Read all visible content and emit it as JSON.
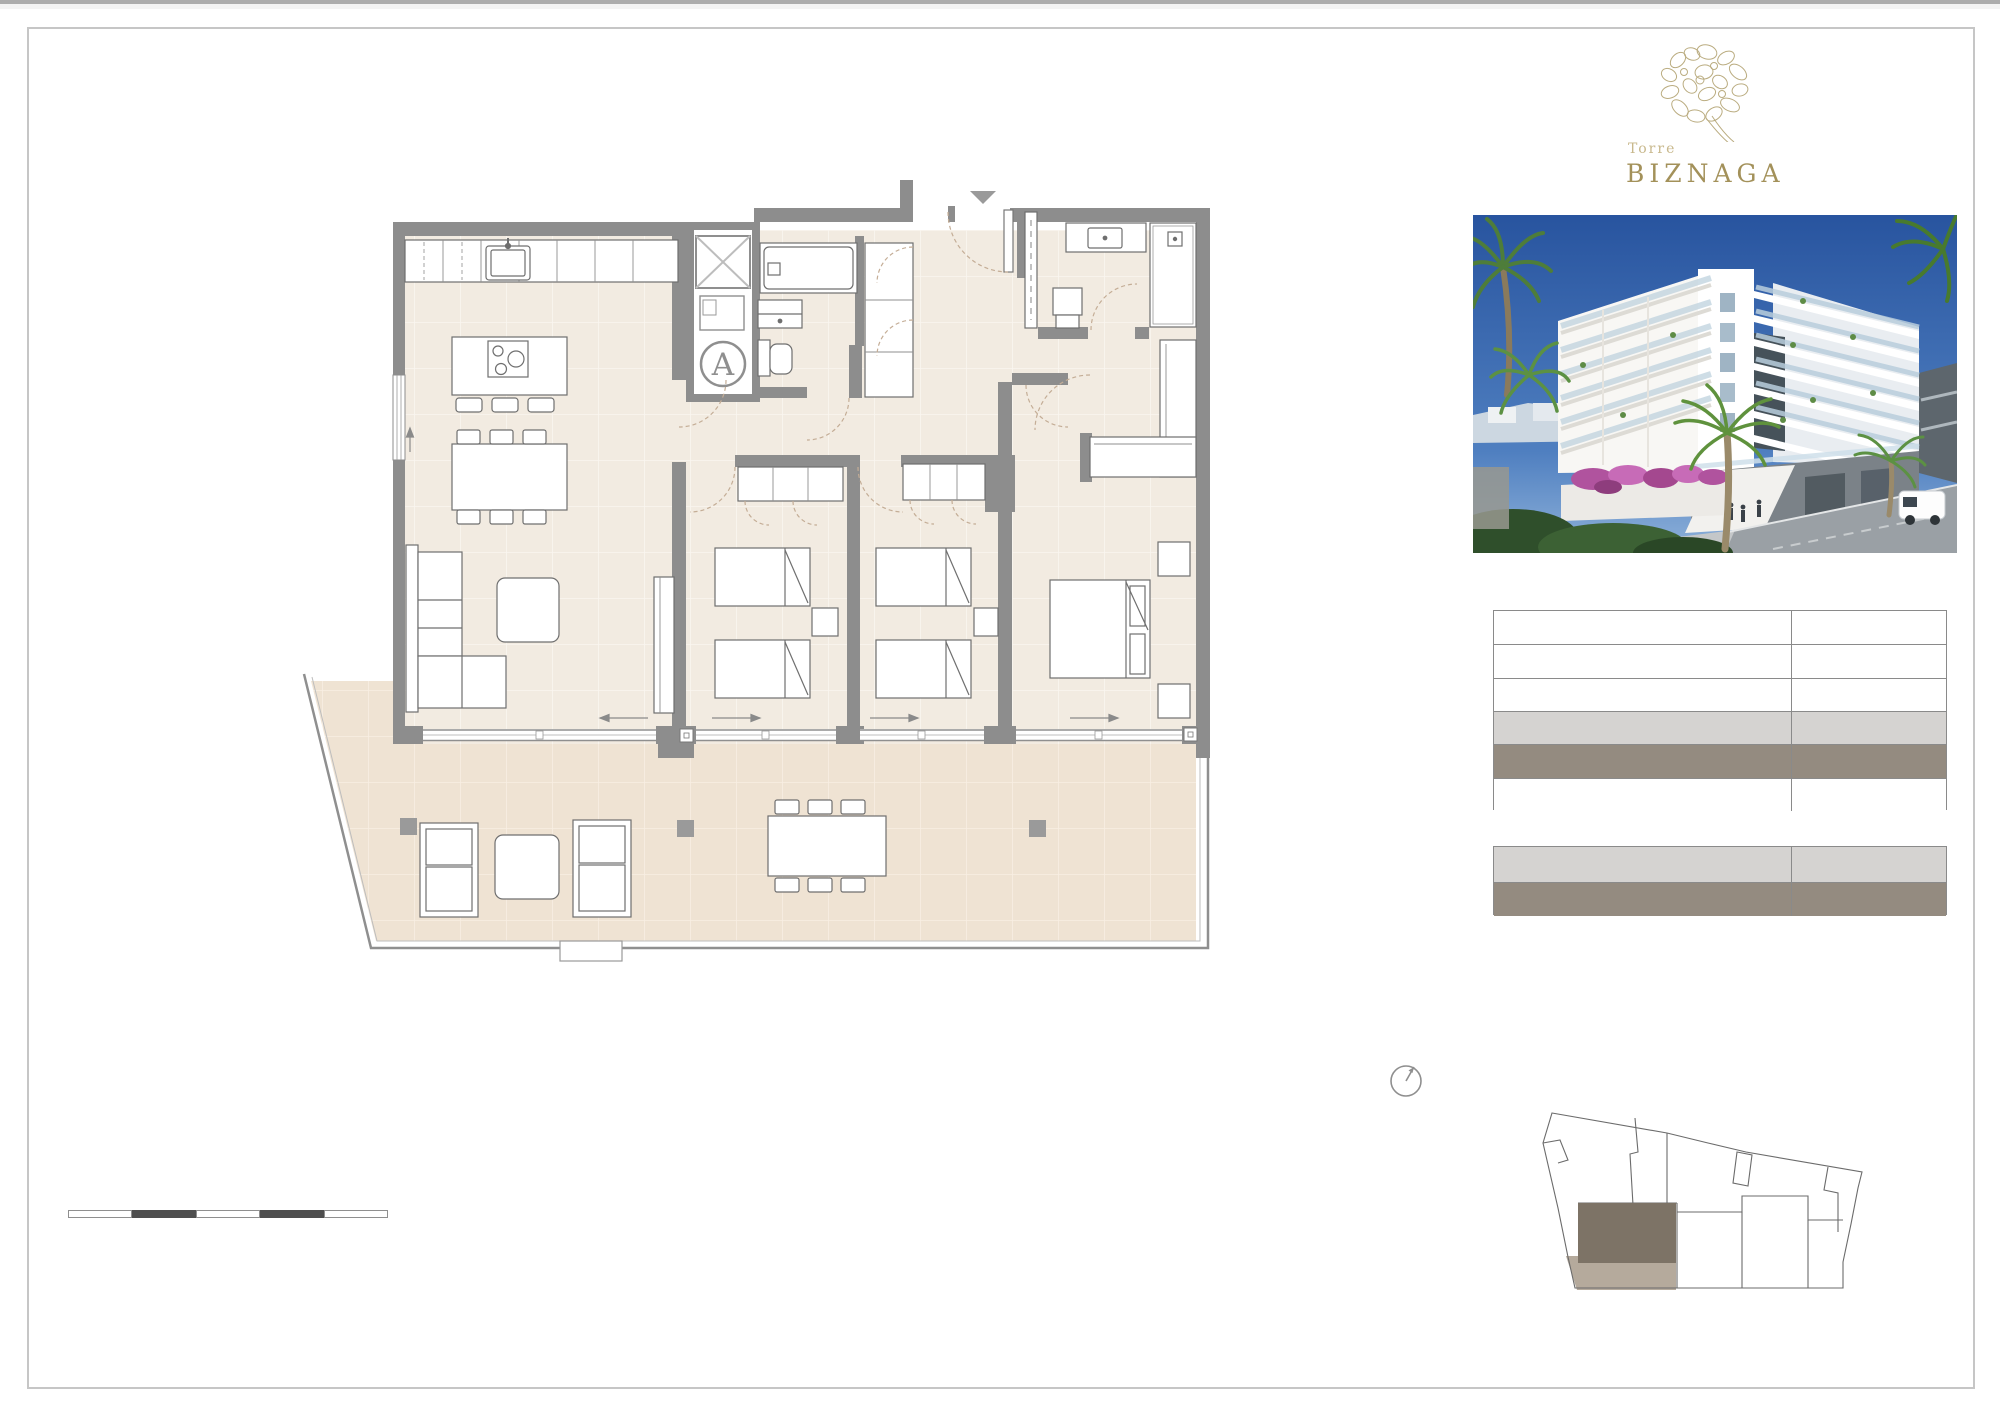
{
  "branding": {
    "project_prefix": "Torre",
    "project_name": "BIZNAGA",
    "logo_icon": "biznaga-flower-icon"
  },
  "floor_plan": {
    "unit_label": "A",
    "markers": [
      "entrance-triangle-icon",
      "elevator-x-icon",
      "north-arrow-icon"
    ],
    "slide_arrows": [
      "left",
      "right",
      "right",
      "right"
    ]
  },
  "colors": {
    "wall_gray": "#8d8d8d",
    "floor_interior": "#f2ebe1",
    "floor_terrace": "#efe3d3",
    "door_arc": "#c4ad96",
    "logo_gold": "#a3915a",
    "logo_gold_light": "#c8b88c",
    "table_light_gray": "#d5d3d1",
    "table_taupe": "#948b80",
    "keyplan_unit": "#7d7366",
    "keyplan_terrace": "#b5aa9c",
    "scalebar_dark": "#4e4e4e",
    "photo_sky": "#2e60aa"
  },
  "tables": {
    "main": {
      "rows": [
        {
          "shade": "#ffffff"
        },
        {
          "shade": "#ffffff"
        },
        {
          "shade": "#ffffff"
        },
        {
          "shade": "#d5d3d1"
        },
        {
          "shade": "#948b80"
        },
        {
          "shade": "#ffffff"
        }
      ]
    },
    "sub": {
      "rows": [
        {
          "shade": "#d5d3d1"
        },
        {
          "shade": "#948b80"
        }
      ]
    }
  },
  "scale_bar": {
    "segments": [
      "#ffffff",
      "#4e4e4e",
      "#ffffff",
      "#4e4e4e",
      "#ffffff"
    ]
  }
}
